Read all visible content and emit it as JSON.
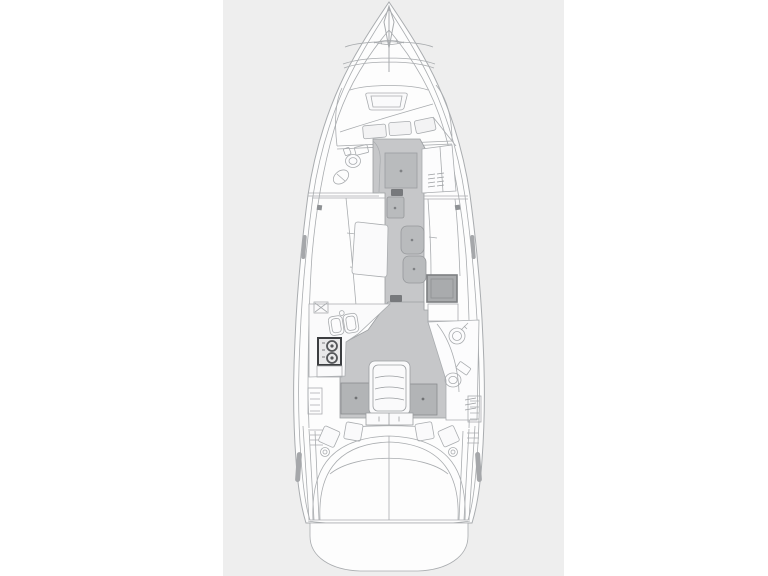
{
  "meta": {
    "title": "Sailing yacht interior layout plan — top view line drawing",
    "view": "deck plan, bow up"
  },
  "colors": {
    "page_bg": "#ffffff",
    "panel_bg": "#eeeeee",
    "hull_fill": "#fdfdfd",
    "deck_fill": "#f8f8f9",
    "room_fill": "#fcfcfd",
    "furniture_white": "#fafafb",
    "line_light": "#b7babd",
    "line_mid": "#9a9da0",
    "line_dark": "#6f7174",
    "floor": "#c6c7c9",
    "floor_border": "#9b9ea1",
    "floor_hatch": "#b9bbbd",
    "cabin_entry": "#b2b4b6",
    "entry_border": "#8a8c8f",
    "fridge": "#a9abad",
    "fridge_border": "#7d7f82",
    "stove_border": "#3c3e41",
    "stove_fill": "#e9e9ea",
    "threshold": "#77797c",
    "window_sliver": "#a5a7aa",
    "pillow_fill": "#f3f3f4"
  },
  "features": {
    "bow": "bow",
    "anchor_locker": "anchor locker",
    "fore_hatch": "foredeck hatch",
    "v_berth": "V-berth double bed",
    "forward_head": "forward head (toilet & sink)",
    "wardrobe": "wardrobe",
    "salon_table": "salon table",
    "port_settee": "port settee",
    "starboard_settee": "starboard settee",
    "walkway": "center walkway",
    "fridge": "fridge / icebox unit",
    "galley": "galley (double sink & stove)",
    "aft_head": "aft head (toilet & sink)",
    "companionway": "companionway steps",
    "port_aft_cabin": "port aft cabin entry",
    "starboard_aft_cabin": "starboard aft cabin entry",
    "cockpit": "cockpit with bench",
    "swim_platform": "stern swim platform"
  }
}
